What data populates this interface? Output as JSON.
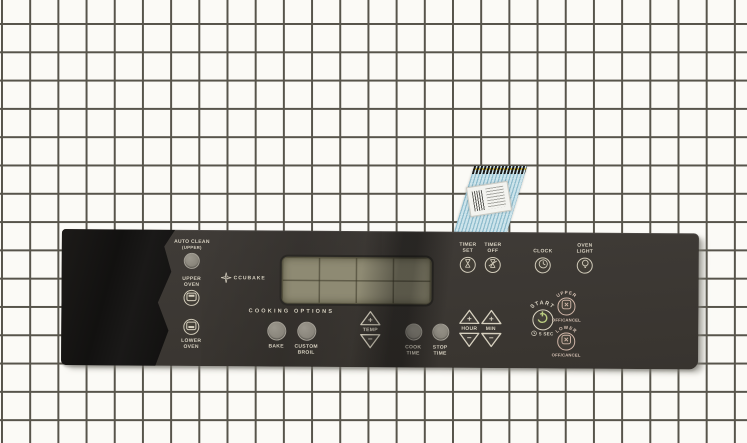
{
  "scene": {
    "description": "oven membrane control panel part photo on white grid backdrop",
    "grid_background": "#fbfaf6",
    "grid_line_color": "#57544b"
  },
  "cable": {
    "kind": "ribbon-cable-with-barcode-label",
    "base_color": "#cde4eb",
    "trace_color": "#8fbccd",
    "tip_color": "#1b1b1b"
  },
  "panel": {
    "colors": {
      "body": "#3b3734",
      "label_cream": "#d8d2c2",
      "start_green": "#b9cc80",
      "cancel_pink": "#d6bcae",
      "display_khaki": "#8e8a73"
    },
    "logo": {
      "letter": "A",
      "text": "CCUBAKE"
    },
    "auto_clean": {
      "line1": "AUTO CLEAN",
      "line2": "(UPPER)"
    },
    "upper_oven": {
      "line1": "UPPER",
      "line2": "OVEN"
    },
    "lower_oven": {
      "line1": "LOWER",
      "line2": "OVEN"
    },
    "cooking_options_heading": "COOKING OPTIONS",
    "bake": {
      "label": "BAKE"
    },
    "custom_broil": {
      "line1": "CUSTOM",
      "line2": "BROIL"
    },
    "temp": {
      "label": "TEMP",
      "plus": "+",
      "minus": "−"
    },
    "cook_time": {
      "line1": "COOK",
      "line2": "TIME"
    },
    "stop_time": {
      "line1": "STOP",
      "line2": "TIME"
    },
    "hour": {
      "label": "HOUR",
      "plus": "+",
      "minus": "−"
    },
    "min": {
      "label": "MIN",
      "plus": "+",
      "minus": "−"
    },
    "timer_set": {
      "line1": "TIMER",
      "line2": "SET"
    },
    "timer_off": {
      "line1": "TIMER",
      "line2": "OFF"
    },
    "clock": {
      "label": "CLOCK"
    },
    "oven_light": {
      "line1": "OVEN",
      "line2": "LIGHT"
    },
    "start": {
      "arc": "START",
      "hold_hint": "5 SEC"
    },
    "upper_cancel": {
      "arc": "UPPER",
      "label": "OFF/CANCEL"
    },
    "lower_cancel": {
      "arc": "LOWER",
      "label": "OFF/CANCEL"
    }
  }
}
